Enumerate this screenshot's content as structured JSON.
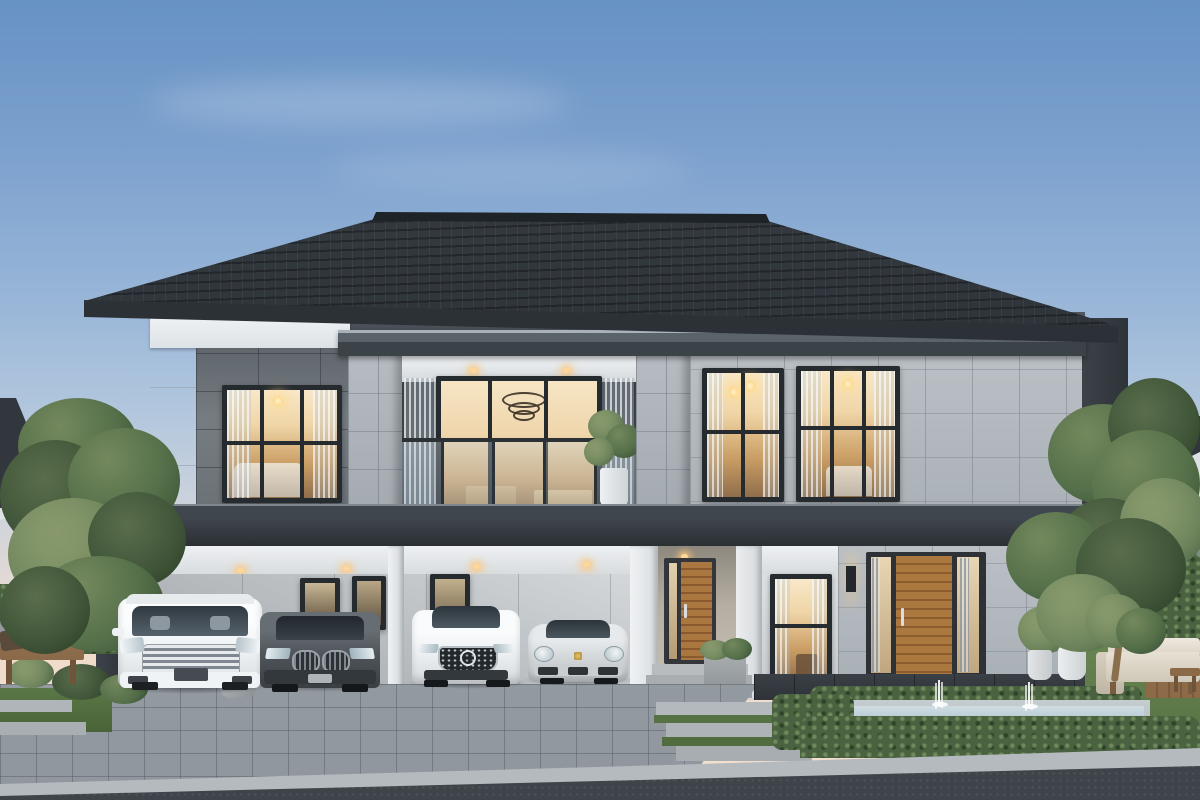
{
  "scene": {
    "title": "Modern two-story luxury house exterior at dusk",
    "style": "3D architectural rendering",
    "time_of_day": "dusk, interior lights on"
  },
  "palette": {
    "sky_top": "#6792c4",
    "sky_horizon": "#f0dccb",
    "roof": "#2c3237",
    "fascia_white": "#edf1f4",
    "panel_dark_gray": "#6d747a",
    "stone_tile": "#b3bac0",
    "slab_dark": "#30363c",
    "wood_door": "#a9773f",
    "window_glow": "#f2d8b0",
    "hedge_green": "#4a6240",
    "lawn_green": "#5f7d4c",
    "paver_gray": "#a3aab0",
    "asphalt": "#3f444a",
    "pool_water": "#b9cdd6"
  },
  "house": {
    "name": "main house",
    "stories": 2,
    "roof": {
      "type": "hip",
      "material": "dark gray tile"
    },
    "upper_floor": {
      "bedroom_window": {
        "name": "lit bedroom window with chandelier and bed"
      },
      "balcony": {
        "name": "central balcony",
        "railing": "frameless glass",
        "sliding_door": "lit living area with ring chandelier",
        "plant": "potted plant",
        "downlights": 2
      },
      "stone_windows": [
        {
          "name": "lit window with pendant lamps"
        },
        {
          "name": "lit window with crystal chandelier"
        }
      ]
    },
    "ground_floor": {
      "carport": {
        "name": "carport",
        "downlights": 4,
        "columns": "white posts and dark corner column with sconce"
      },
      "entrance": {
        "door": {
          "name": "wooden front door with glass sidelight"
        },
        "porch_light": 1,
        "steps": 3
      },
      "side_window": {
        "name": "lit ground-floor window with curtains"
      },
      "right_wing": {
        "door": {
          "name": "tall wooden door with curtained sidelights"
        },
        "sconce": 1,
        "material": "gray stone tile"
      }
    }
  },
  "cars": [
    {
      "name": "white luxury minivan",
      "color": "#f4f6f7"
    },
    {
      "name": "dark gray SUV",
      "color": "#50565c"
    },
    {
      "name": "white sedan",
      "color": "#f2f4f6"
    },
    {
      "name": "silver sports coupe",
      "color": "#d6dadd"
    }
  ],
  "yard": {
    "driveway": {
      "material": "gray pavers"
    },
    "road": {
      "material": "dark asphalt"
    },
    "pool": {
      "name": "reflecting pool with fountain jets",
      "fountain_jets": 2,
      "border": "boxwood hedges"
    },
    "walkways": {
      "stepping_stones": true,
      "grass_joints": true
    },
    "lawn": {
      "position": "right of pool"
    }
  },
  "garden_left": {
    "bench": {
      "name": "wooden garden bench with cushions"
    },
    "plants": [
      "ornamental grass",
      "hedge",
      "mature tree"
    ]
  },
  "garden_right": {
    "sofa": {
      "name": "outdoor lounge sofa with white cushions"
    },
    "coffee_table": true,
    "planters": 2,
    "plants": [
      "tropical plants",
      "hedge wall",
      "mature trees"
    ]
  },
  "neighborhood": {
    "left_house": "dark hip roof behind tree",
    "right_house": "white house with dark roof behind trees"
  }
}
